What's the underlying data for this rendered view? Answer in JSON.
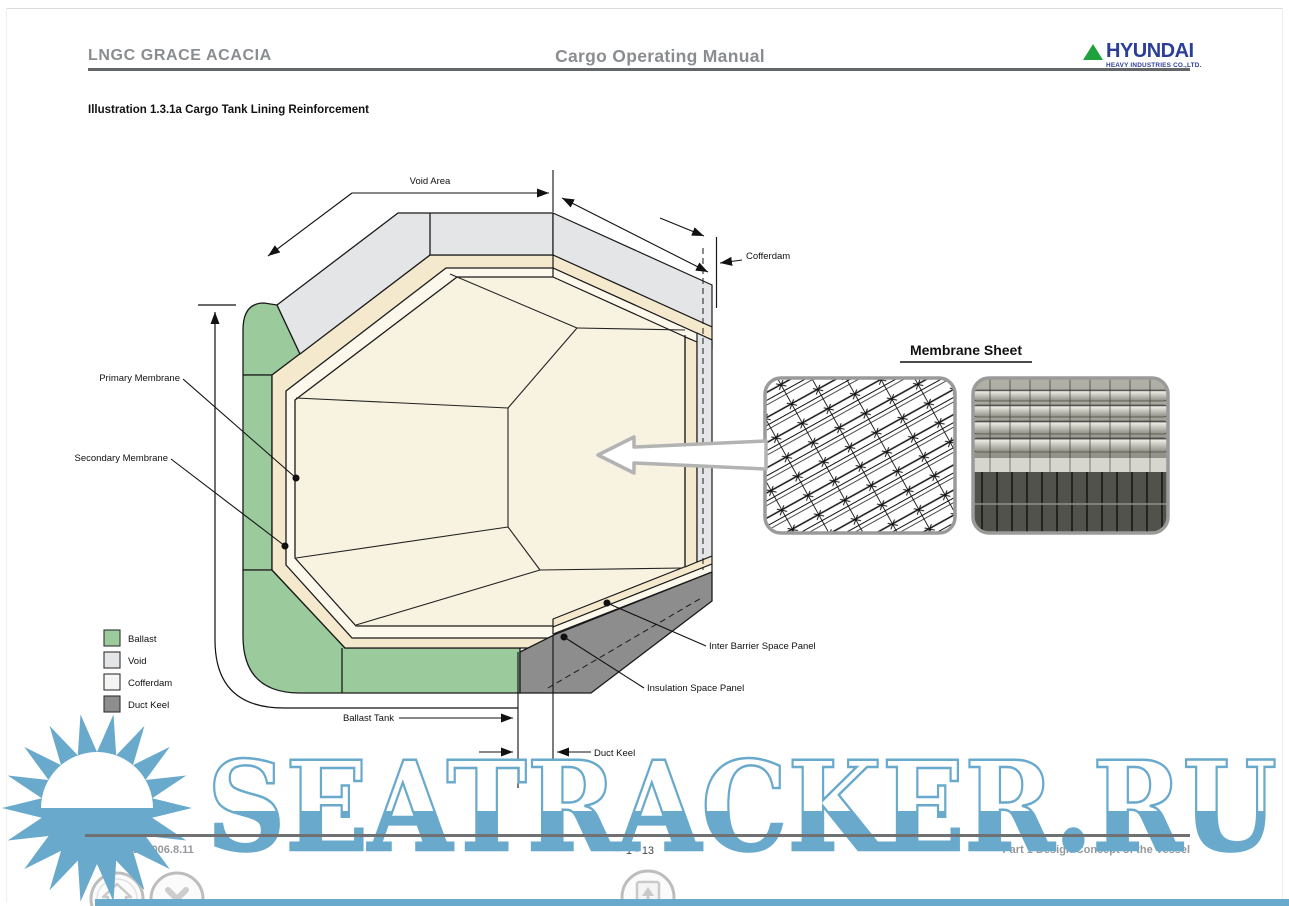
{
  "header": {
    "ship_name": "LNGC GRACE ACACIA",
    "doc_title": "Cargo Operating Manual",
    "logo_brand": "HYUNDAI",
    "logo_sub": "HEAVY INDUSTRIES CO.,LTD."
  },
  "illustration_title": "Illustration 1.3.1a Cargo Tank Lining Reinforcement",
  "diagram": {
    "dim_labels": {
      "void_area": "Void Area",
      "cofferdam": "Cofferdam",
      "ballast_tank": "Ballast Tank",
      "duct_keel": "Duct Keel"
    },
    "callouts": {
      "primary_membrane": "Primary Membrane",
      "secondary_membrane": "Secondary Membrane",
      "inter_barrier": "Inter Barrier Space Panel",
      "insulation": "Insulation Space Panel"
    },
    "legend": [
      {
        "label": "Ballast",
        "color": "#9bcb9d"
      },
      {
        "label": "Void",
        "color": "#e4e5e7"
      },
      {
        "label": "Cofferdam",
        "color": "#f5f5f3"
      },
      {
        "label": "Duct Keel",
        "color": "#8d8d8d"
      }
    ],
    "membrane_title": "Membrane Sheet"
  },
  "footer": {
    "left": "2nd Draft / 2006.8.11",
    "page": "1 - 13",
    "right": "Part 1 Design Concept of the Vessel"
  },
  "watermark": {
    "text": "SEATRACKER.RU",
    "color": "#68a9cc"
  },
  "nav": [
    {
      "icon": "home"
    },
    {
      "icon": "close"
    },
    {
      "icon": "page-up"
    }
  ]
}
